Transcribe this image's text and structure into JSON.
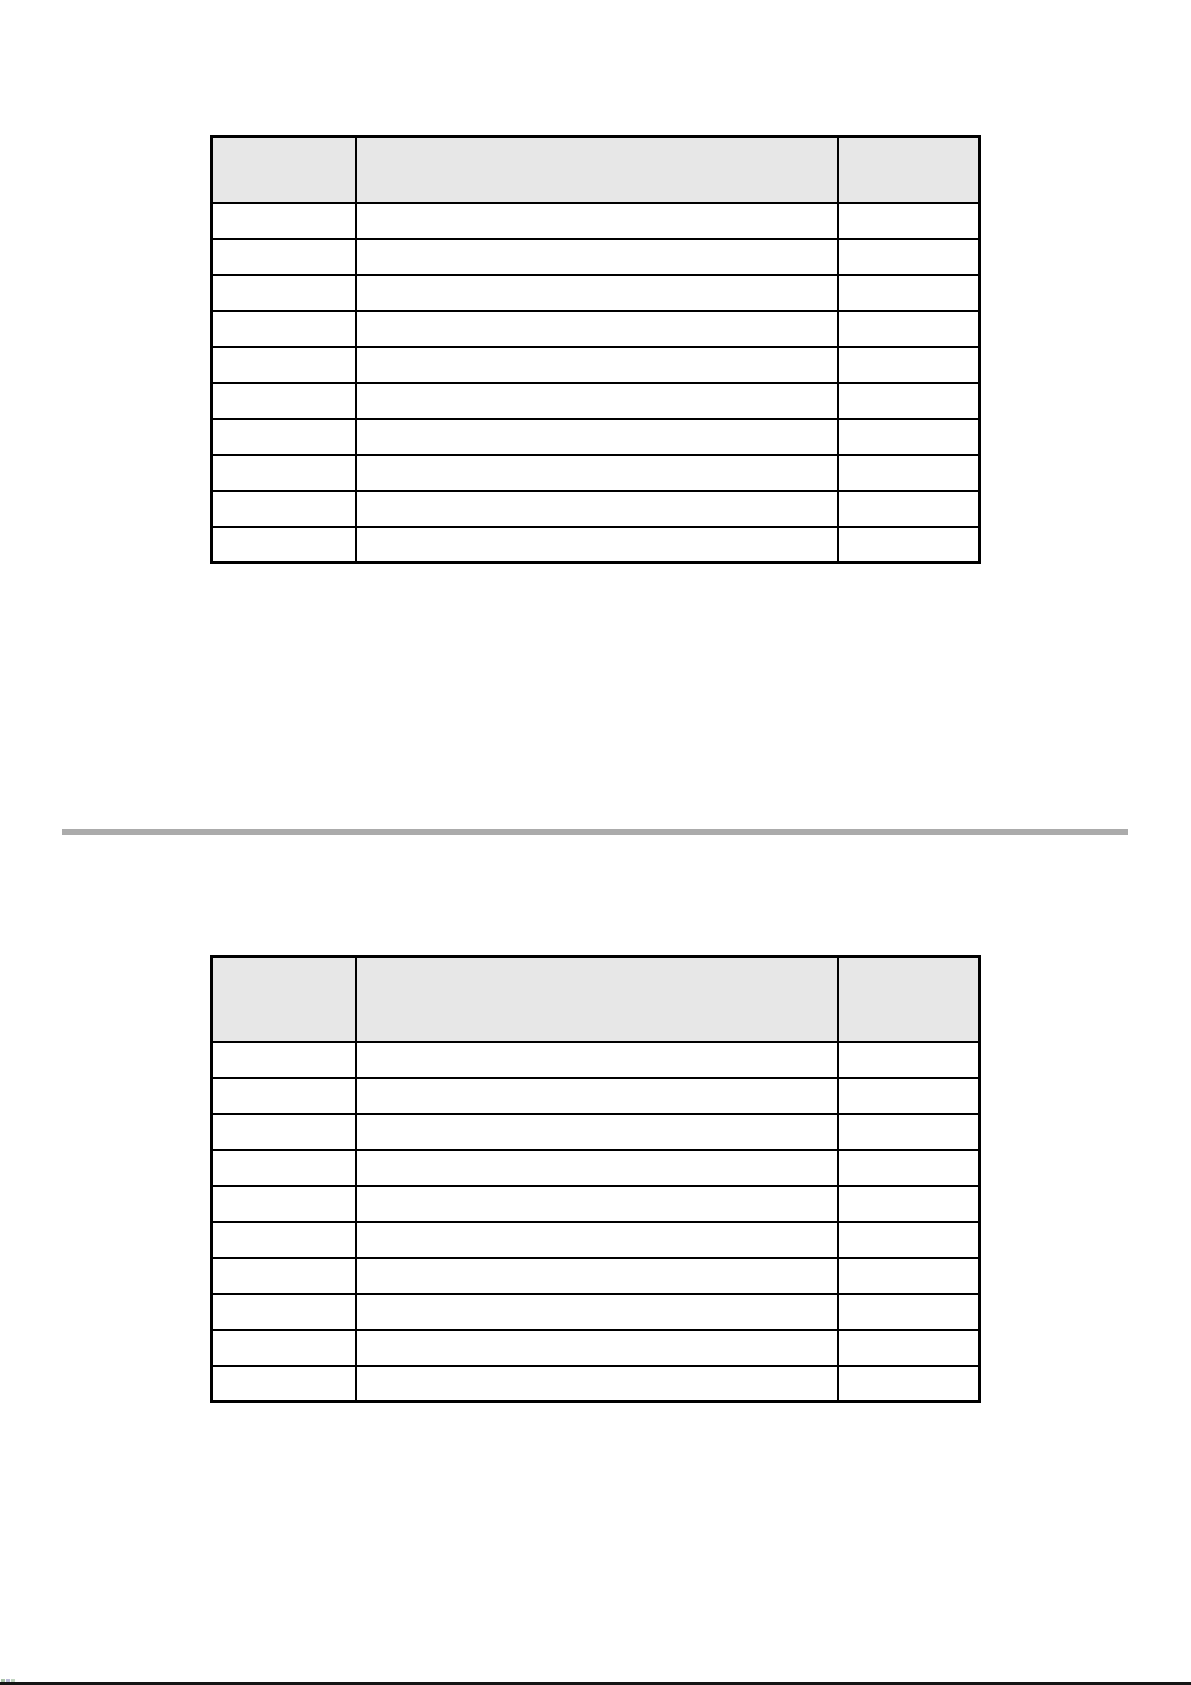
{
  "page": {
    "background_color": "#ffffff"
  },
  "tables": [
    {
      "name": "upper-empty-table",
      "header": {
        "background_color": "#e7e7e7",
        "cells": [
          "",
          "",
          ""
        ]
      },
      "rows": [
        [
          "",
          "",
          ""
        ],
        [
          "",
          "",
          ""
        ],
        [
          "",
          "",
          ""
        ],
        [
          "",
          "",
          ""
        ],
        [
          "",
          "",
          ""
        ],
        [
          "",
          "",
          ""
        ],
        [
          "",
          "",
          ""
        ],
        [
          "",
          "",
          ""
        ],
        [
          "",
          "",
          ""
        ],
        [
          "",
          "",
          ""
        ]
      ]
    },
    {
      "name": "lower-empty-table",
      "header": {
        "background_color": "#e7e7e7",
        "cells": [
          "",
          "",
          ""
        ]
      },
      "rows": [
        [
          "",
          "",
          ""
        ],
        [
          "",
          "",
          ""
        ],
        [
          "",
          "",
          ""
        ],
        [
          "",
          "",
          ""
        ],
        [
          "",
          "",
          ""
        ],
        [
          "",
          "",
          ""
        ],
        [
          "",
          "",
          ""
        ],
        [
          "",
          "",
          ""
        ],
        [
          "",
          "",
          ""
        ],
        [
          "",
          "",
          ""
        ]
      ]
    }
  ],
  "divider": {
    "color": "#ababab"
  },
  "bottom_line": {
    "color": "#151515"
  },
  "corner_artifact": {
    "colors": [
      "#a9c4a9",
      "#b9b9d6",
      "#c2d6c2"
    ]
  },
  "border_color": "#000000"
}
